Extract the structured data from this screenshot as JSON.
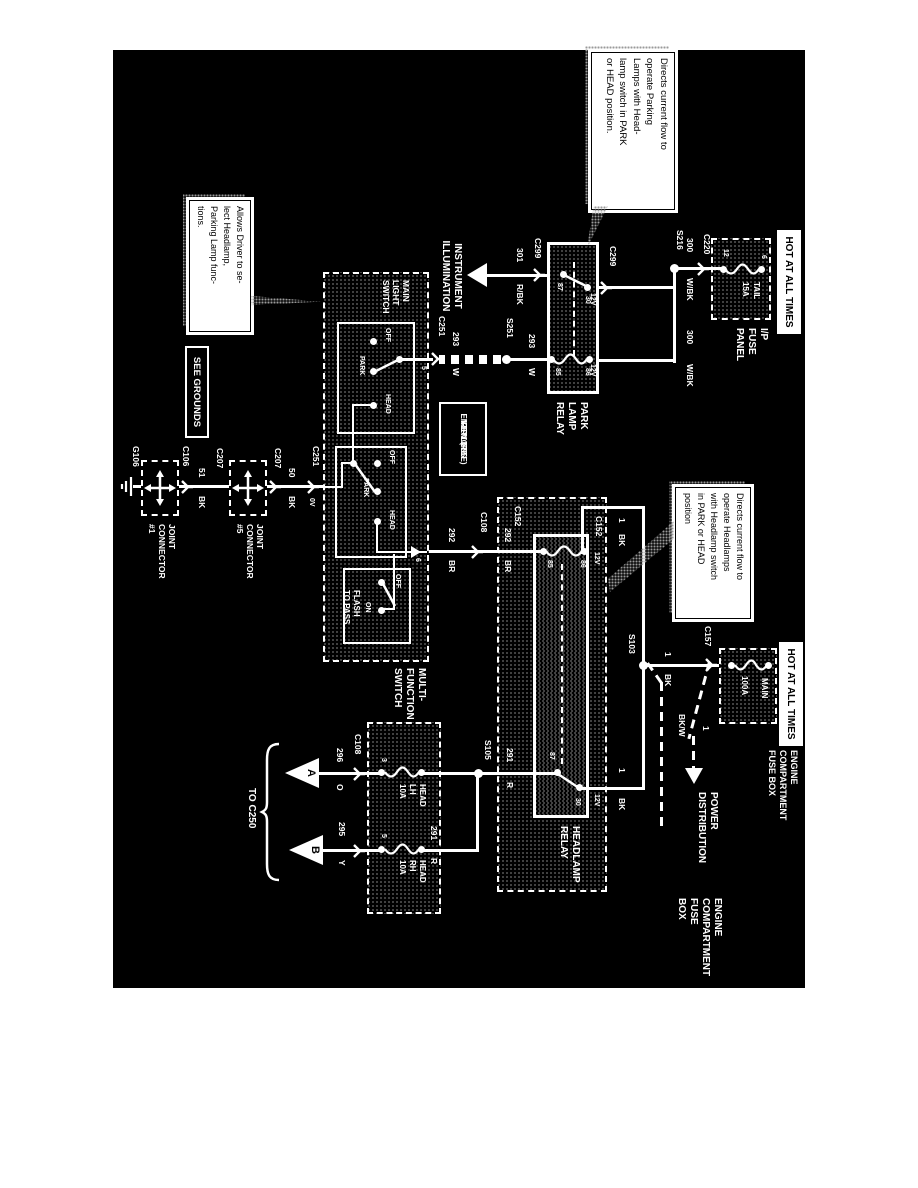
{
  "banners": {
    "hot_1": "HOT AT ALL TIMES",
    "hot_2": "HOT AT ALL TIMES",
    "see_grounds": "SEE GROUNDS"
  },
  "callouts": {
    "park_relay": {
      "lines": [
        "Directs current flow to",
        "operate Parking",
        "Lamps with Head-",
        "lamp switch in PARK",
        "or HEAD position."
      ]
    },
    "head_relay": {
      "lines": [
        "Directs current flow to",
        "operate Headlamps",
        "with Headlamp switch",
        "in PARK or HEAD",
        "position"
      ]
    },
    "mfs": {
      "lines": [
        "Allows Driver to se-",
        "lect Headlamp,",
        "Parking Lamp func-",
        "tions."
      ]
    }
  },
  "ip_fuse_panel": {
    "label": [
      "I/P",
      "FUSE",
      "PANEL"
    ],
    "fuse_name": "TAIL",
    "fuse_rating": "15A",
    "pin_top": "6",
    "pin_bottom": "12"
  },
  "eng_fuse_box_small": {
    "label": [
      "ENGINE",
      "COMPARTMENT",
      "FUSE BOX"
    ],
    "fuse_name": "MAIN",
    "fuse_rating": "100A"
  },
  "eng_fuse_box_big": {
    "label": [
      "ENGINE",
      "COMPARTMENT",
      "FUSE",
      "BOX"
    ]
  },
  "head_fuses": {
    "lh": [
      "HEAD",
      "LH",
      "10A"
    ],
    "rh": [
      "HEAD",
      "RH",
      "10A"
    ],
    "pin_lh": "3",
    "pin_rh": "5"
  },
  "park_relay": {
    "label": [
      "PARK",
      "LAMP",
      "RELAY"
    ],
    "pin_30": "30",
    "pin_87": "87",
    "pin_85": "85",
    "pin_86": "86",
    "volt": "12V"
  },
  "head_relay": {
    "label": [
      "HEADLAMP",
      "RELAY"
    ],
    "pin_30": "30",
    "pin_87": "87",
    "pin_85": "85",
    "pin_86": "86",
    "volt": "12V"
  },
  "mfs": {
    "label": [
      "MULTI-",
      "FUNCTION",
      "SWITCH"
    ],
    "main_light_switch": [
      "MAIN",
      "LIGHT",
      "SWITCH"
    ],
    "off": "OFF",
    "park": "PARK",
    "head": "HEAD",
    "ftp_label": [
      "FLASH",
      "TO PASS"
    ],
    "ftp_off": "OFF",
    "ftp_on": "ON",
    "pin_5": "5",
    "pin_6": "6"
  },
  "rke": {
    "label": [
      "REMOTE",
      "KEYLESS",
      "ENTRY (RKE)"
    ]
  },
  "illumination": {
    "label": [
      "INSTRUMENT",
      "ILLUMINATION"
    ]
  },
  "power_dist": {
    "label": [
      "POWER",
      "DISTRIBUTION"
    ]
  },
  "connectors": {
    "c220": "C220",
    "c299": "C299",
    "c251": "C251",
    "c108": "C108",
    "c152": "C152",
    "c157": "C157",
    "c207": "C207",
    "c106": "C106"
  },
  "splices": {
    "s216": "S216",
    "s251": "S251",
    "s103": "S103",
    "s105": "S105"
  },
  "grounds": {
    "g106": "G106",
    "jc5": [
      "JOINT",
      "CONNECTOR",
      "#5"
    ],
    "jc1": [
      "JOINT",
      "CONNECTOR",
      "#1"
    ]
  },
  "wires": {
    "w300": {
      "num": "300",
      "color": "W/BK"
    },
    "w301": {
      "num": "301",
      "color": "R/BK"
    },
    "w293": {
      "num": "293",
      "color": "W"
    },
    "w292": {
      "num": "292",
      "color": "BR"
    },
    "w291": {
      "num": "291",
      "color": "R"
    },
    "w296": {
      "num": "296",
      "color": "O"
    },
    "w295": {
      "num": "295",
      "color": "Y"
    },
    "w1": {
      "num": "1",
      "color": "BK"
    },
    "w1bw": {
      "num": "1",
      "color": "BK/W"
    },
    "w50": {
      "num": "50",
      "color": "BK"
    },
    "w51": {
      "num": "51",
      "color": "BK"
    },
    "volt_0": "0V"
  },
  "offpage": {
    "a": "A",
    "b": "B",
    "to": "TO C250"
  }
}
